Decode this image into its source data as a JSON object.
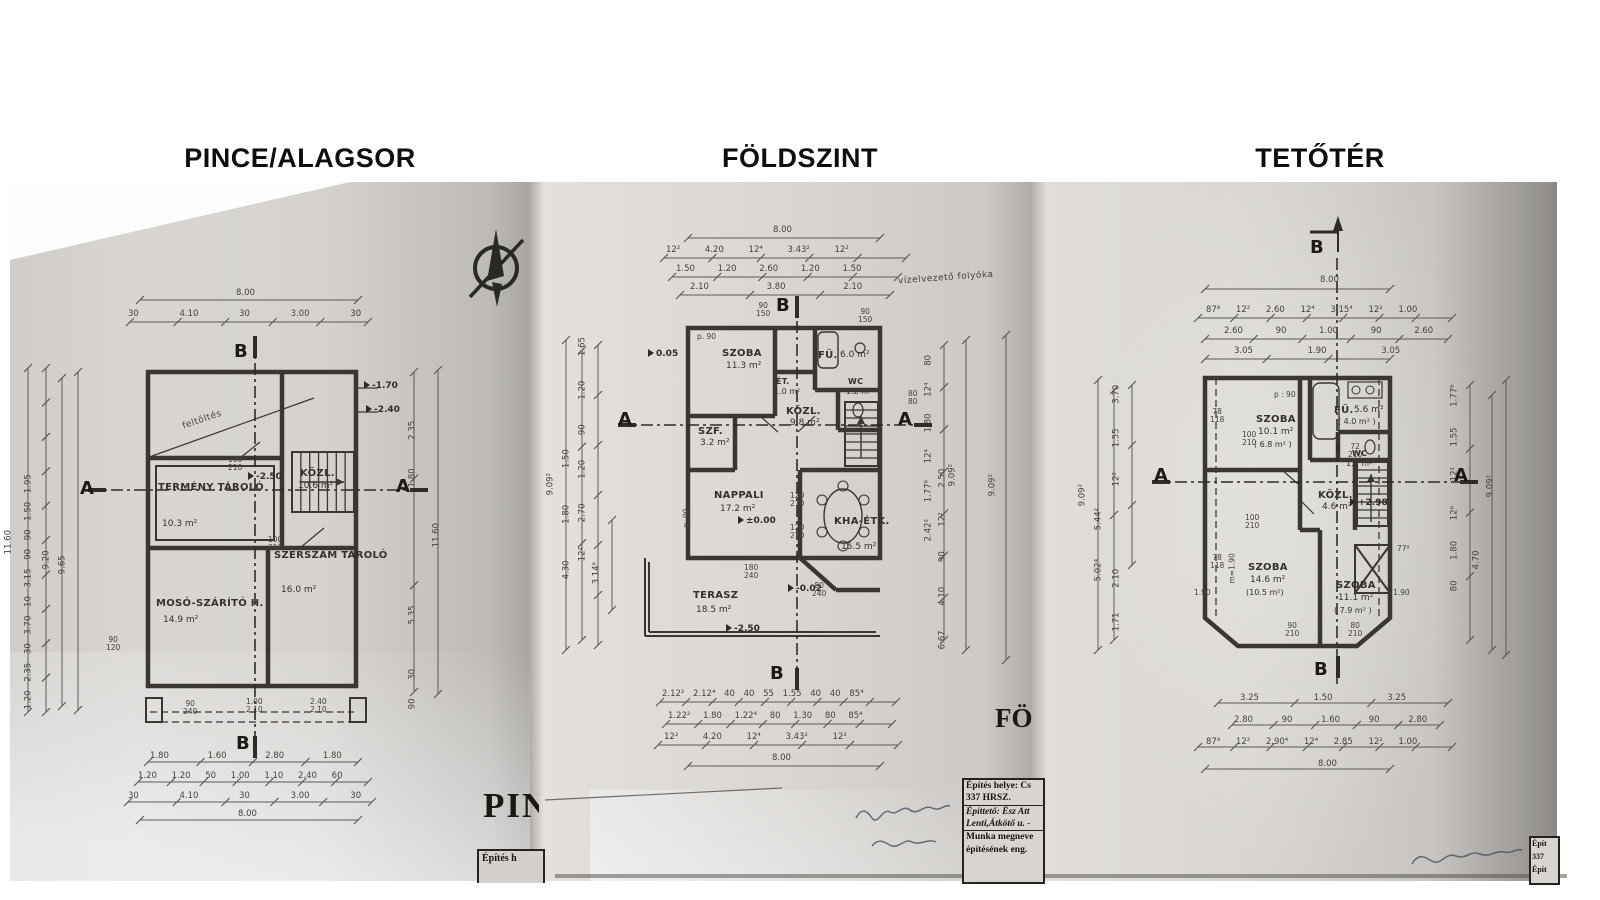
{
  "titles": [
    "PINCE/ALAGSOR",
    "FÖLDSZINT",
    "TETŐTÉR"
  ],
  "basement": {
    "rooms": [
      {
        "name": "TERMÉNY TÁROLÓ",
        "area": "10.3 m²"
      },
      {
        "name": "KÖZL.",
        "area": "10.6 m²"
      },
      {
        "name": "SZERSZÁM TÁROLÓ",
        "area": "16.0 m²"
      },
      {
        "name": "MOSÓ-SZÁRÍTÓ H.",
        "area": "14.9 m²"
      }
    ],
    "levels": {
      "main": "-2.50",
      "r1": "-1.70",
      "r2": "-2.40"
    },
    "note": "feltöltés",
    "tags": [
      "100\n210",
      "100\n210",
      "90\n240",
      "1.00\n2.10",
      "2.40\n2.10",
      "90\n120"
    ],
    "dims": {
      "top": [
        "8.00",
        "30 4.10 30 3.00 30"
      ],
      "bottom": [
        "1.80 1.60 2.80 1.80",
        "1.20 1.20 50 1.00 1.10 2.40 60",
        "30 4.10 30 3.00 30",
        "8.00"
      ],
      "left": [
        "11.60",
        "1.20 2.35 30 3.70 10 3.15 90 90 1.50 1.95",
        "9.20",
        "9.65"
      ],
      "right": [
        "1.80 2.35",
        "11.60",
        "5.35",
        "90 30"
      ]
    },
    "markers": {
      "a": "A",
      "b": "B"
    }
  },
  "ground": {
    "rooms": [
      {
        "name": "SZOBA",
        "area": "11.3 m²"
      },
      {
        "name": "FÜ.",
        "area": "6.0 m²"
      },
      {
        "name": "ÉT.",
        "area": "1.0 m²"
      },
      {
        "name": "WC",
        "area": "1.2 m²"
      },
      {
        "name": "SZF.",
        "area": "3.2 m²"
      },
      {
        "name": "KÖZL.",
        "area": "9.8 m²"
      },
      {
        "name": "NAPPALI",
        "area": "17.2 m²"
      },
      {
        "name": "KHA-ÉTK.",
        "area": "15.5 m²"
      },
      {
        "name": "TERASZ",
        "area": "18.5 m²"
      }
    ],
    "levels": {
      "zero": "±0.00",
      "terrace": "-0.02",
      "lower": "-2.50",
      "entry": "0.05"
    },
    "note": "vízelvezető folyóka",
    "tags": [
      "p. 90",
      "p. 90",
      "90\n150",
      "90\n150",
      "120\n210",
      "120\n210",
      "180\n240",
      "80\n240",
      "80\n80"
    ],
    "dims": {
      "top": [
        "8.00",
        "12² 4.20 12⁴ 3.43² 12²",
        "1.50 1.20 2.60 1.20 1.50",
        "2.10 3.80 2.10"
      ],
      "bottom": [
        "2.12² 2.12⁴ 40 40 55 1.55 40 40 85⁴",
        "1.22² 1.80 1.22⁴ 80 1.30 80 85⁴",
        "12² 4.20 12⁴ 3.43² 12²",
        "8.00"
      ],
      "left": [
        "9.09²",
        "4.30 1.80 1.50",
        "12² 2.70 1.20 90 1.20 1.65",
        "3.14⁶"
      ],
      "right": [
        "2.42² 1.77⁶ 12⁴ 1.80 12⁴ 80",
        "6.67 4.10 90 12² 2.50",
        "9.09²",
        "9.09²"
      ]
    },
    "markers": {
      "a": "A",
      "b": "B"
    }
  },
  "attic": {
    "rooms": [
      {
        "name": "SZOBA",
        "area": "10.1 m²",
        "area2": "( 6.8 m² )"
      },
      {
        "name": "FÜ.",
        "area": "5.6 m²",
        "area2": "( 4.0 m² )"
      },
      {
        "name": "WC",
        "area": "1.1 m²",
        "area2": ""
      },
      {
        "name": "KÖZL.",
        "area": "4.6 m²",
        "area2": ""
      },
      {
        "name": "SZOBA",
        "area": "14.6 m²",
        "area2": "(10.5 m²)"
      },
      {
        "name": "SZOBA",
        "area": "11.1 m²",
        "area2": "( 7.9 m² )"
      }
    ],
    "levels": {
      "main": "+2.98"
    },
    "tags": [
      "p : 90",
      "100\n210",
      "100\n210",
      "72\n210",
      "m=1.90",
      "77⁸",
      "1.90",
      "1.90",
      "90\n210",
      "80\n210",
      "78\n118",
      "78\n118"
    ],
    "dims": {
      "top": [
        "8.00",
        "87⁸ 12² 2.60 12⁴ 3.15⁴ 12² 1.00",
        "2.60 90 1.00 90 2.60",
        "3.05 1.90 3.05"
      ],
      "bottom": [
        "3.25 1.50 3.25",
        "2.80 90 1.60 90 2.80",
        "87⁸ 12² 2.90⁴ 12⁴ 2.85 12² 1.00",
        "8.00"
      ],
      "left": [
        "9.09²",
        "5.02⁴ 5.44²",
        "12² 1.55 3.70",
        "1.71 2.10"
      ],
      "right": [
        "12² 1.55 1.77⁶",
        "80 1.80 12⁶",
        "4.70",
        "9.09²"
      ]
    },
    "markers": {
      "a": "A",
      "b": "B"
    }
  },
  "stamps": {
    "middle": {
      "l1": "Építés helye: Cs",
      "l2": "337 HRSZ.",
      "l3": "Építtető: Ész Att",
      "l4": "Lenti,Átkötő u. -",
      "l5": "Munka megneve",
      "l6": "építésének eng."
    },
    "right": {
      "l1": "Épít",
      "l2": "337",
      "l3": "Épít"
    },
    "left": {
      "l1": "Építés h"
    },
    "partial_left": "PIN",
    "partial_mid": "FÖ"
  }
}
